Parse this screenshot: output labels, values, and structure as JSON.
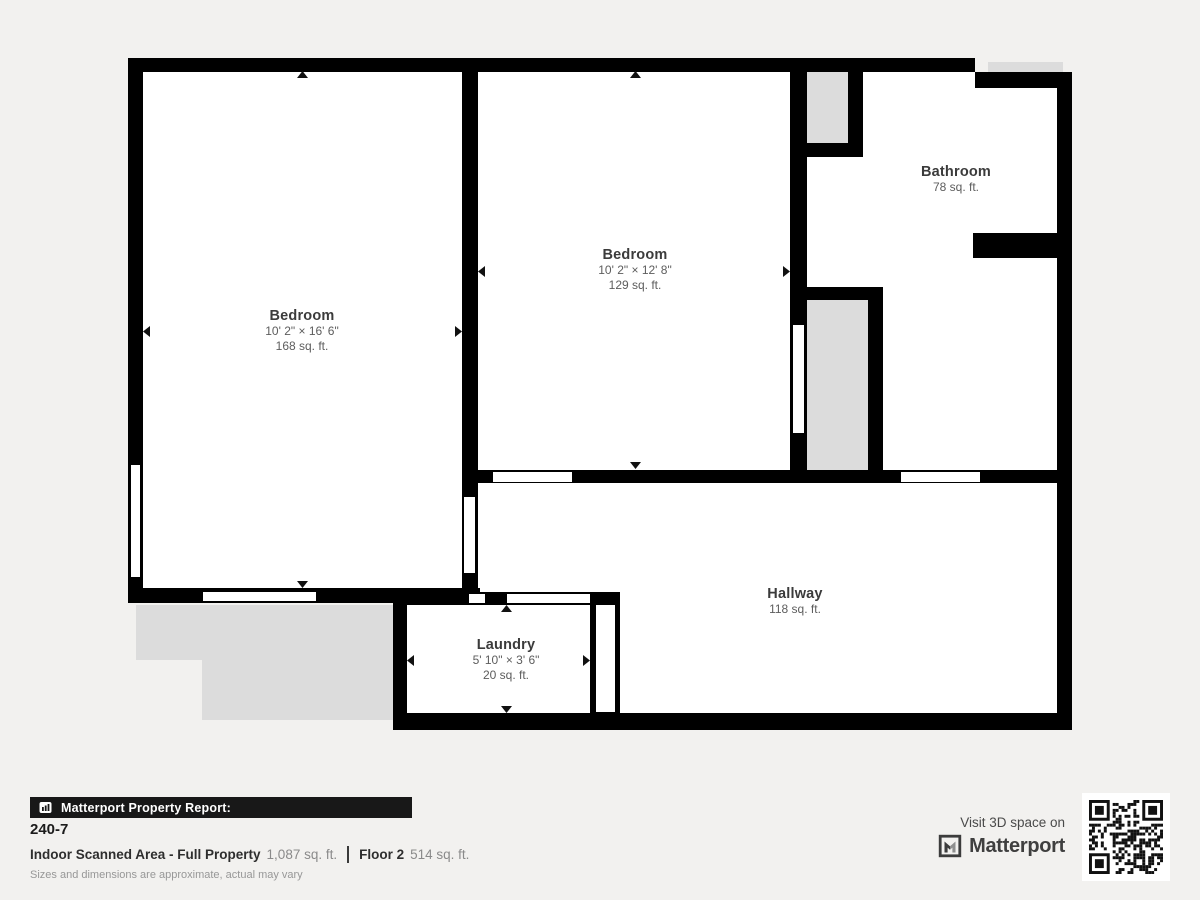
{
  "plan": {
    "colors": {
      "wall": "#000000",
      "floor": "#ffffff",
      "unscanned": "#dcdcdc",
      "background": "#f2f1ef"
    },
    "rooms": [
      {
        "id": "bedroom-1",
        "name": "Bedroom",
        "dimensions": "10' 2\" × 16' 6\"",
        "area": "168 sq. ft."
      },
      {
        "id": "bedroom-2",
        "name": "Bedroom",
        "dimensions": "10' 2\" × 12' 8\"",
        "area": "129 sq. ft."
      },
      {
        "id": "bathroom",
        "name": "Bathroom",
        "area": "78 sq. ft."
      },
      {
        "id": "hallway",
        "name": "Hallway",
        "area": "118 sq. ft."
      },
      {
        "id": "laundry",
        "name": "Laundry",
        "dimensions": "5' 10\" × 3' 6\"",
        "area": "20 sq. ft."
      }
    ]
  },
  "report": {
    "banner_title": "Matterport Property Report:",
    "property_id": "240-7",
    "indoor_area_label": "Indoor Scanned Area - Full Property",
    "indoor_area_value": "1,087 sq. ft.",
    "floor_label": "Floor 2",
    "floor_value": "514 sq. ft.",
    "disclaimer": "Sizes and dimensions are approximate, actual may vary"
  },
  "promo": {
    "visit_text": "Visit 3D space on",
    "brand": "Matterport"
  }
}
